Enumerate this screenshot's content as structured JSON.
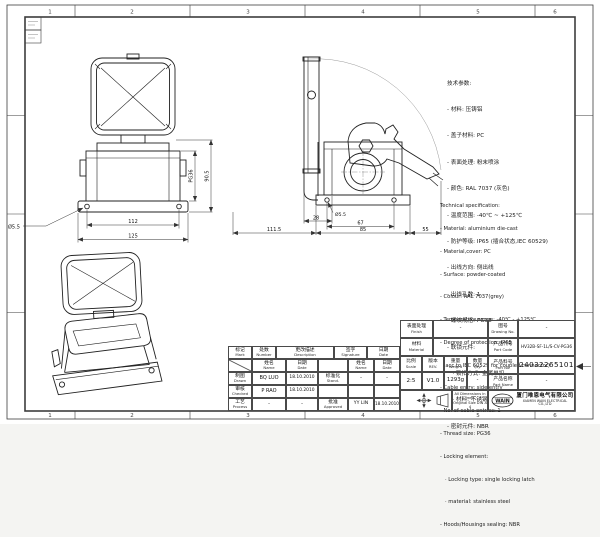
{
  "sheet": {
    "grid_numbers": [
      "1",
      "2",
      "3",
      "4",
      "5",
      "6"
    ]
  },
  "specs_cn": {
    "title": "技术参数:",
    "lines": [
      "- 材料: 压铸铝",
      "- 盖子材料: PC",
      "- 表面处理: 粉末喷涂",
      "- 颜色: RAL 7037 (灰色)",
      "- 温度范围: -40℃ ~ +125℃",
      "- 防护等级: IP65 (插合状态,IEC 60529)",
      "- 出线方向: 侧出线",
      "- 出线孔数: 1",
      "- 螺纹规格: PG36",
      "- 联锁元件:",
      "   · 锁扣方式: 金属单扣",
      "   · 材料: 不锈钢",
      "- 密封元件: NBR"
    ]
  },
  "specs_en": {
    "title": "Technical specification:",
    "lines": [
      "- Material: aluminium die-cast",
      "- Material,cover: PC",
      "- Surface: powder-coated",
      "- Colour: RAL 7037(grey)",
      "- Temperature range: -40℃ - +125℃",
      "- Degree of protection: IP65",
      "  (acc.to IEC 60529 for coupled connector)",
      "- Cable entry: side entry",
      "- No. of cable entries: 1",
      "- Thread size: PG36",
      "- Locking element:",
      "   · Locking type: single locking latch",
      "   · material: stainless steel",
      "- Hoods/Housings sealing: NBR"
    ]
  },
  "dims": {
    "front_inner_width": "112",
    "front_outer_width": "125",
    "front_height": "90.5",
    "thread": "PG36",
    "hole_dia": "Ø5.5",
    "side_offset": "28",
    "side_hole_spacing": "67",
    "side_total": "111.5",
    "side_base": "85",
    "side_latch": "55"
  },
  "title_block": {
    "headers": {
      "mark_cn": "标记",
      "mark_en": "Mark",
      "number_cn": "处数",
      "number_en": "Number",
      "description_cn": "更改描述",
      "description_en": "Description",
      "signature_cn": "签字",
      "signature_en": "Signature",
      "date_cn": "日期",
      "date_en": "Date",
      "name_cn": "姓名",
      "name_en": "Name"
    },
    "roles": {
      "drawn_cn": "制图",
      "drawn_en": "Drawn",
      "checked_cn": "审核",
      "checked_en": "Checked",
      "process_cn": "工艺",
      "process_en": "Process",
      "standard_cn": "标准化",
      "standard_en": "Stand.",
      "approved_cn": "批准",
      "approved_en": "Approved"
    },
    "values": {
      "drawn_name": "BQ LUO",
      "drawn_date": "18.10.2010",
      "checked_name": "P RAO",
      "checked_date": "18.10.2010",
      "process_name": "-",
      "process_date": "-",
      "standard_name": "-",
      "standard_date": "-",
      "approved_name": "YY LIN",
      "approved_date": "18.10.2010"
    },
    "fields": {
      "finish_cn": "表面处理",
      "finish_en": "Finish",
      "finish_value": "-",
      "material_cn": "材料",
      "material_en": "Material",
      "material_value": "-",
      "scale_cn": "比例",
      "scale_en": "Scale",
      "scale_value": "2:5",
      "rev_cn": "版本",
      "rev_en": "REV.",
      "rev_value": "V1.0",
      "weight_cn": "重量",
      "weight_en": "Weight",
      "weight_value": "1293g",
      "qty_cn": "数量",
      "qty_en": "Qty.",
      "qty_value": "-",
      "drawing_no_cn": "图号",
      "drawing_no_en": "Drawing No.",
      "drawing_no_value": "-",
      "part_code_cn": "产品代号",
      "part_code_en": "Part Code",
      "part_code_value": "HV32B-SF-1L/S-CV-PG36",
      "part_no_cn": "产品料号",
      "part_no_en": "Part No.",
      "part_no_value": "1240322651013",
      "part_name_cn": "产品名称",
      "part_name_en": "Part Name",
      "part_name_value": "-"
    },
    "notes": {
      "line1": "All Dimensions in mm",
      "line2": "Original Size DIN A 4"
    },
    "company": {
      "logo": "WAIN",
      "name_cn": "厦门唯恩电气有限公司",
      "name_en": "XIAMEN WAIN ELECTRICAL CO.,LTD"
    }
  }
}
